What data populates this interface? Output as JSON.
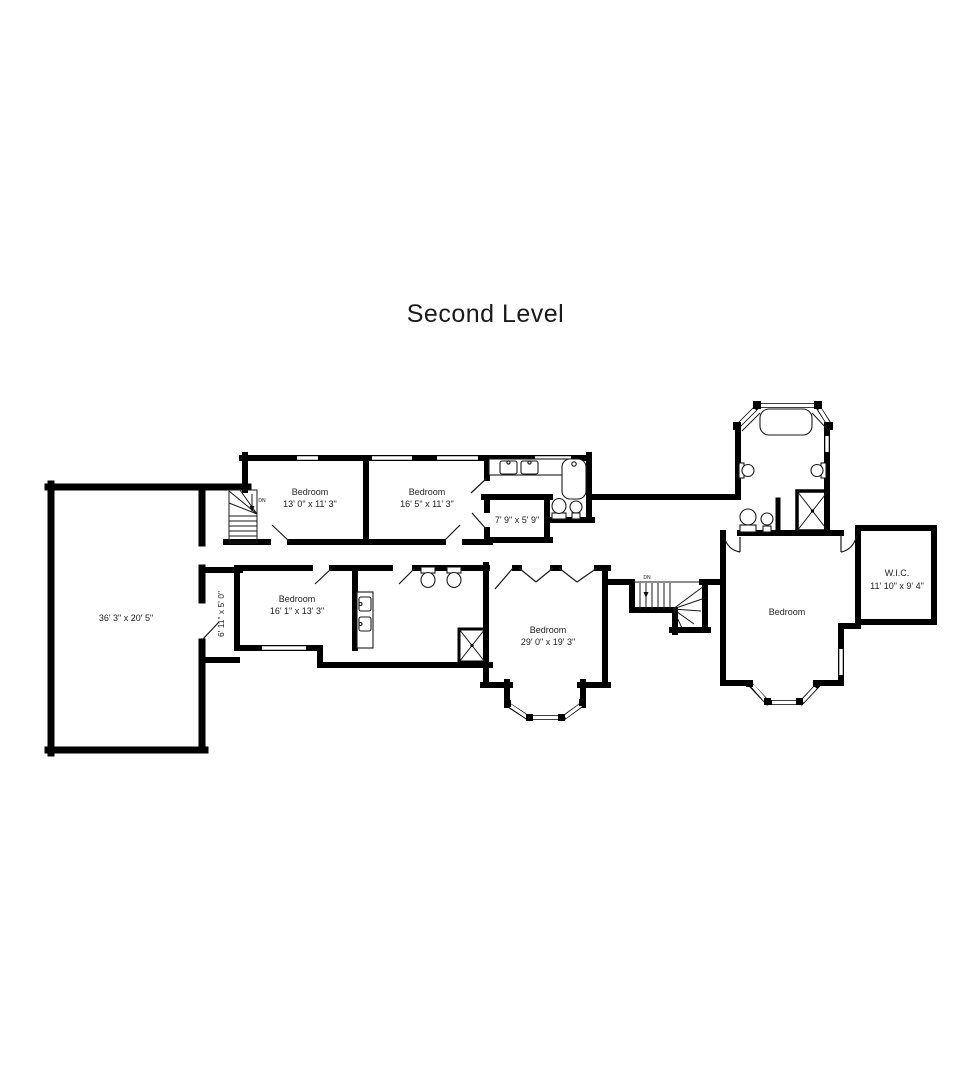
{
  "title": "Second Level",
  "labels": {
    "bonus_room": {
      "dims": "36' 3\" x 20' 5\""
    },
    "bedroom_one": {
      "name": "Bedroom",
      "dims": "13' 0\" x 11' 3\""
    },
    "bedroom_two": {
      "name": "Bedroom",
      "dims": "16' 5\" x 11' 3\""
    },
    "bath_nook": {
      "dims": "7' 9\" x 5' 9\""
    },
    "hall_closet": {
      "dims": "6' 11\" x 5' 0\""
    },
    "bedroom_three": {
      "name": "Bedroom",
      "dims": "16' 1\" x 13' 3\""
    },
    "bedroom_four": {
      "name": "Bedroom",
      "dims": "29' 0\" x 19' 3\""
    },
    "bedroom_five": {
      "name": "Bedroom"
    },
    "wic": {
      "name": "W.I.C.",
      "dims": "11' 10\" x 9' 4\""
    },
    "stair_down_1": "DN",
    "stair_down_2": "DN"
  },
  "colors": {
    "wall": "#000000",
    "background": "#ffffff",
    "label": "#222222"
  }
}
